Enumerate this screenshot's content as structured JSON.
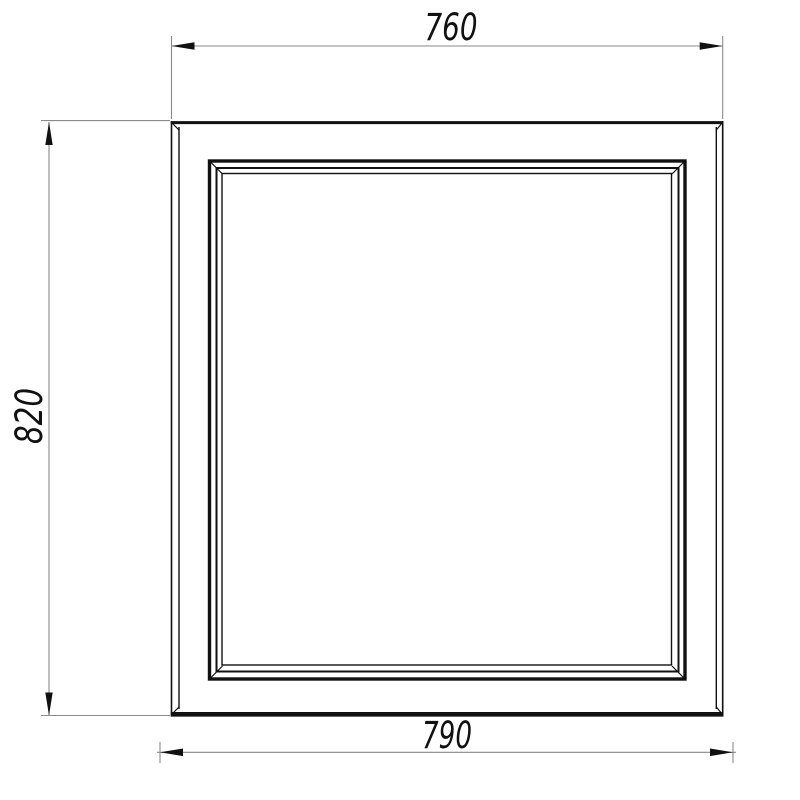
{
  "drawing": {
    "dimensions": {
      "top_width": "760",
      "side_height": "820",
      "bottom_width": "790"
    },
    "colors": {
      "line": "#111111",
      "dimension_line": "#8a8a8a",
      "background": "#ffffff"
    }
  }
}
